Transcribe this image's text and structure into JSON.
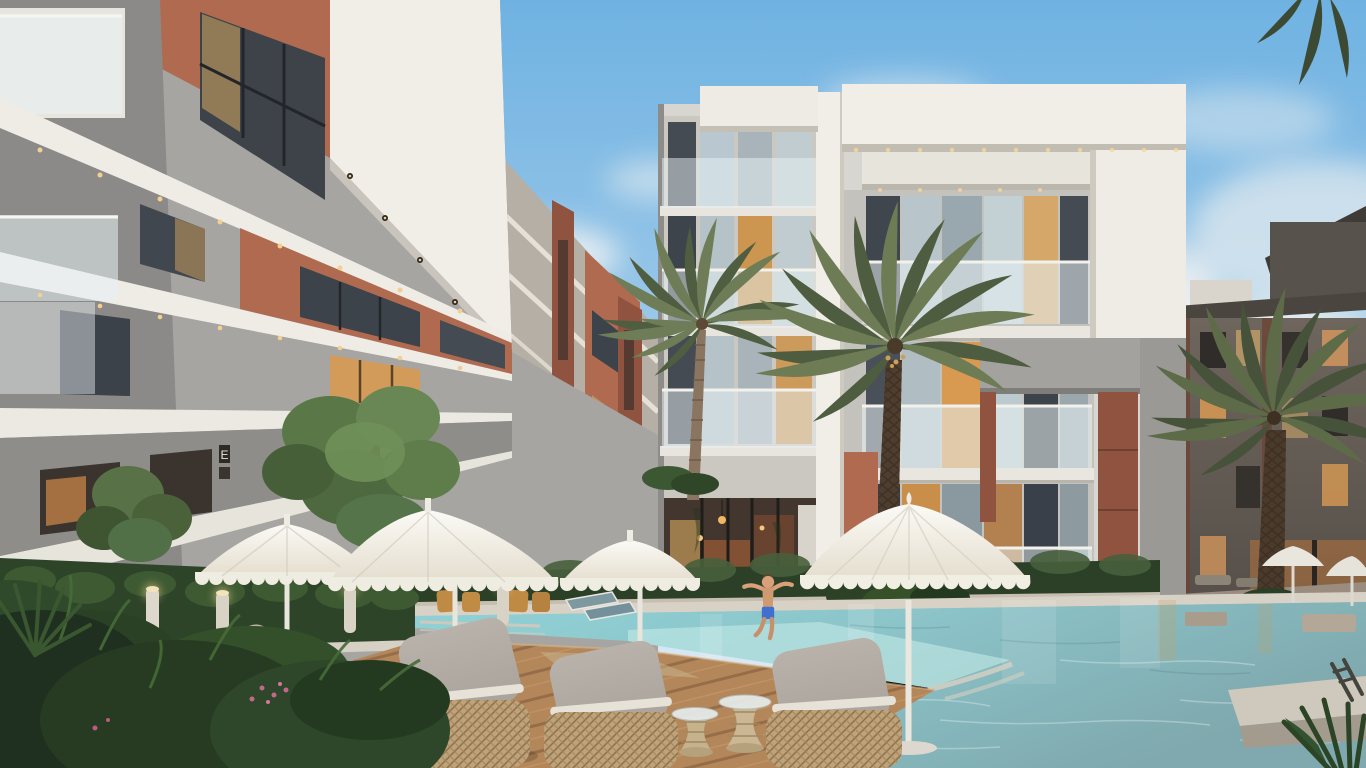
{
  "meta": {
    "title": "Residential complex courtyard - architectural rendering",
    "type": "3d-architectural-render",
    "time_of_day": "dusk",
    "resolution": "1366x768"
  },
  "scene": {
    "description": "Modern low-rise apartment complex courtyard at dusk: white and terracotta buildings with glass balconies and warm lit windows surround a turquoise swimming pool, wooden deck, white lace-fringed patio umbrellas, wicker lounge chairs, bollard lights, palm trees and landscaped planters. A child in blue swim shorts jumps into the pool.",
    "signage": {
      "entrance_plaque": "E"
    },
    "objects": [
      "left apartment building with terracotta panels",
      "central white apartment building with cantilevered frames",
      "right dusk-lit apartment block",
      "courtyard mid-rise wing",
      "swimming pool",
      "pool coping and stone platform",
      "pool ladder",
      "wooden deck",
      "white fringed patio umbrellas",
      "wicker lounge chairs with grey cushions",
      "woven side tables",
      "bollard lights",
      "hedge planters",
      "courtyard trees",
      "palm trees",
      "teal sun loungers",
      "cafe chairs",
      "evening sky with clouds"
    ],
    "figures": [
      {
        "name": "child jumping into pool",
        "clothing": "blue swim shorts"
      }
    ],
    "counts": {
      "large_umbrellas": 4,
      "small_umbrellas": 2,
      "wicker_chairs": 4,
      "palm_trees": 3,
      "bollard_lights": 4
    }
  },
  "palette": {
    "sky_top": "#6fb2e2",
    "sky_horizon": "#dcebf3",
    "cloud_white": "#edefee",
    "building_white": "#f1eee8",
    "building_white_shadow": "#d7d4cd",
    "concrete_grey": "#a6a5a1",
    "concrete_dark": "#8b8a88",
    "terracotta": "#b06a50",
    "terracotta_dark": "#8f5340",
    "window_dark": "#3e4349",
    "window_warm": "#d89a52",
    "glass_reflect": "#b9c8d0",
    "balcony_glass": "#e8f1f4",
    "palm_green": "#6e7d57",
    "palm_green_dark": "#4f5d40",
    "palm_trunk": "#8a7560",
    "palm_trunk_dark": "#4e3e2f",
    "hedge_green": "#2c4027",
    "pool_light": "#bfe6e3",
    "pool_turquoise": "#8fd2d6",
    "pool_deep": "#7fa9ae",
    "coping_stone": "#d8d2c6",
    "deck_wood": "#b3875a",
    "deck_wood_dark": "#7c583a",
    "umbrella_white": "#fbfaf6",
    "umbrella_shade": "#e4ddcd",
    "wicker_tan": "#bfa279",
    "cushion_grey": "#a9a39b",
    "dusk_building": "#6e665d",
    "lit_window": "#e8b464",
    "kid_skin": "#d9a07a",
    "kid_shorts": "#3f6fd0"
  }
}
